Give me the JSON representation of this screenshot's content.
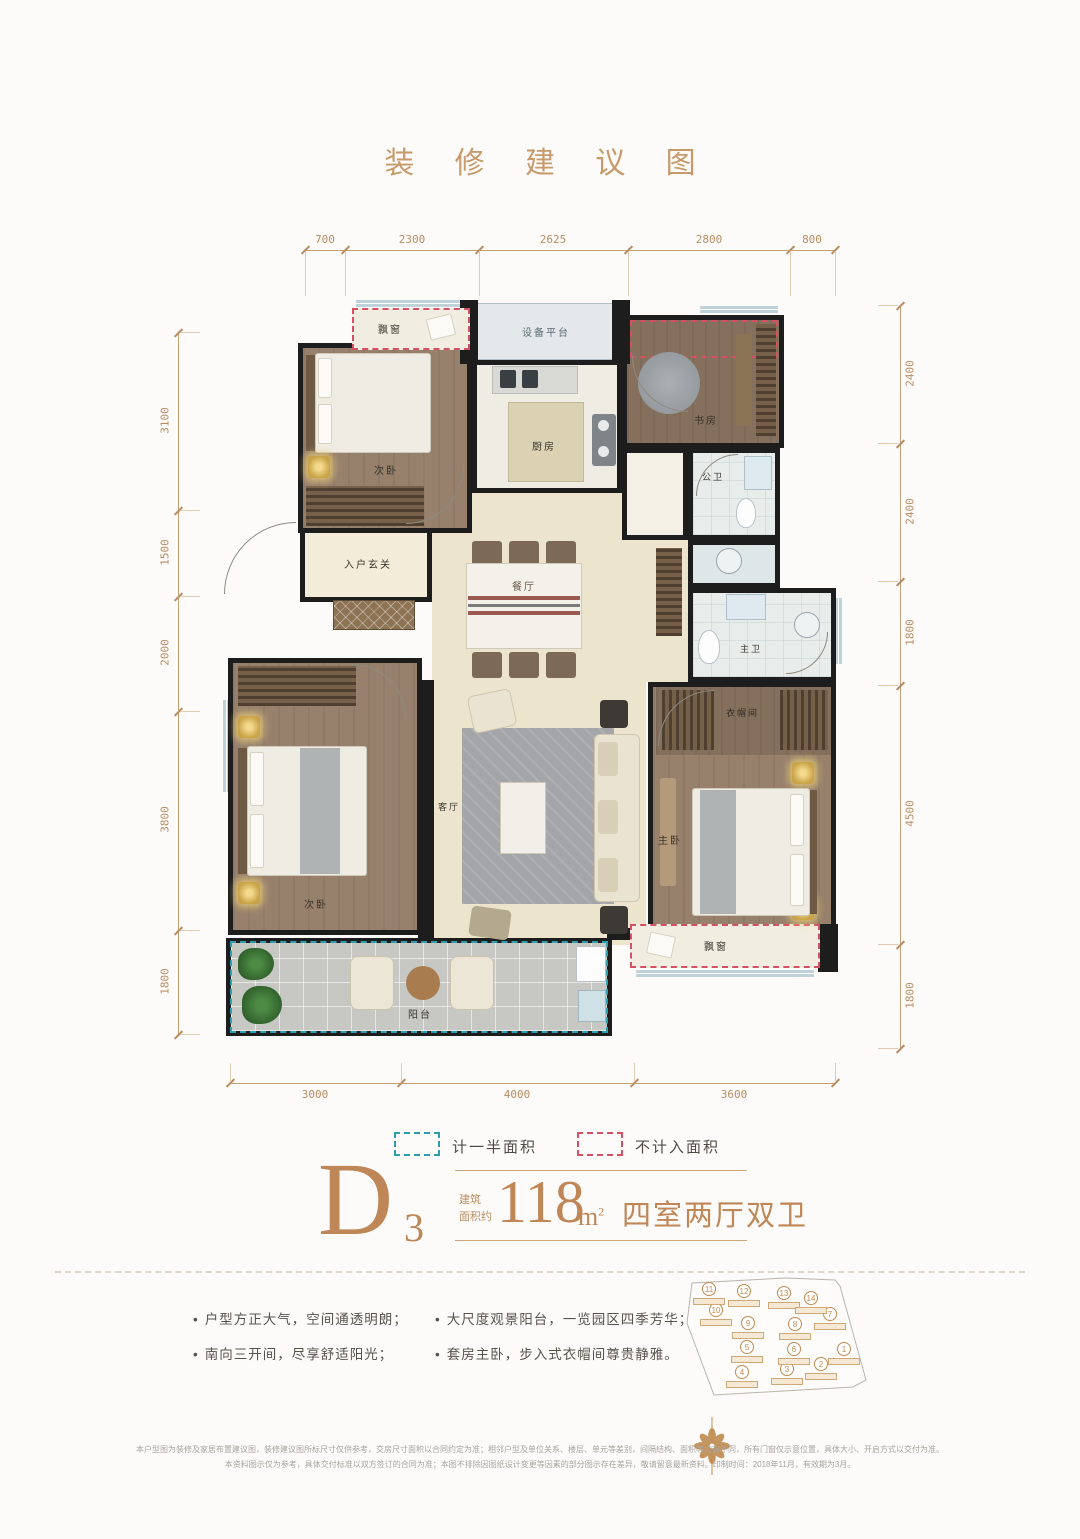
{
  "page": {
    "title": "装 修 建 议 图"
  },
  "plan": {
    "rooms": {
      "bay_top": "飘窗",
      "equipment": "设备平台",
      "bedroom_top": "次卧",
      "kitchen": "厨房",
      "study": "书房",
      "guest_bath": "公卫",
      "entry": "入户玄关",
      "dining": "餐厅",
      "master_bath": "主卫",
      "closet": "衣帽间",
      "bedroom_left": "次卧",
      "living": "客厅",
      "master_bedroom": "主卧",
      "bay_bottom": "飘窗",
      "balcony": "阳台"
    },
    "dimensions": {
      "top": [
        "700",
        "2300",
        "2625",
        "2800",
        "800"
      ],
      "left": [
        "3100",
        "1500",
        "2000",
        "3800",
        "1800"
      ],
      "right": [
        "2400",
        "2400",
        "1800",
        "4500",
        "1800"
      ],
      "bottom": [
        "3000",
        "4000",
        "3600"
      ]
    }
  },
  "legend": {
    "half_area_label": "计一半面积",
    "half_area_color": "#2e9fb0",
    "excluded_area_label": "不计入面积",
    "excluded_area_color": "#d45064"
  },
  "unit": {
    "letter": "D",
    "number": "3",
    "area_prefix": [
      "建筑",
      "面积约"
    ],
    "area_value": "118",
    "area_unit": "m",
    "area_sup": "2",
    "layout_text": "四室两厅双卫"
  },
  "features": {
    "col1": [
      "户型方正大气，空间通透明朗；",
      "南向三开间，尽享舒适阳光；"
    ],
    "col2": [
      "大尺度观景阳台，一览园区四季芳华；",
      "套房主卧，步入式衣帽间尊贵静雅。"
    ]
  },
  "site_map": {
    "buildings": [
      {
        "n": "1",
        "x": 172,
        "y": 81
      },
      {
        "n": "2",
        "x": 149,
        "y": 96
      },
      {
        "n": "3",
        "x": 115,
        "y": 101
      },
      {
        "n": "4",
        "x": 70,
        "y": 104
      },
      {
        "n": "5",
        "x": 75,
        "y": 79
      },
      {
        "n": "6",
        "x": 122,
        "y": 81
      },
      {
        "n": "7",
        "x": 158,
        "y": 46
      },
      {
        "n": "8",
        "x": 123,
        "y": 56
      },
      {
        "n": "9",
        "x": 76,
        "y": 55
      },
      {
        "n": "10",
        "x": 44,
        "y": 42
      },
      {
        "n": "11",
        "x": 37,
        "y": 21
      },
      {
        "n": "12",
        "x": 72,
        "y": 23
      },
      {
        "n": "13",
        "x": 112,
        "y": 25
      },
      {
        "n": "14",
        "x": 139,
        "y": 30
      }
    ]
  },
  "disclaimer": {
    "line1": "本户型图为装修及家居布置建议图，装修建议图所标尺寸仅供参考，交房尺寸面积以合同约定为准；相邻户型及单位关系、楼层、单元等差别，间隔结构、面积等均有不同，所有门窗仅示意位置，具体大小、开启方式以交付为准。",
    "line2": "本资料图示仅为参考，具体交付标准以双方签订的合同为准；本图不排除因图纸设计变更等因素的部分图示存在差异，敬请留意最新资料。印制时间：2018年11月，有效期为3月。"
  }
}
